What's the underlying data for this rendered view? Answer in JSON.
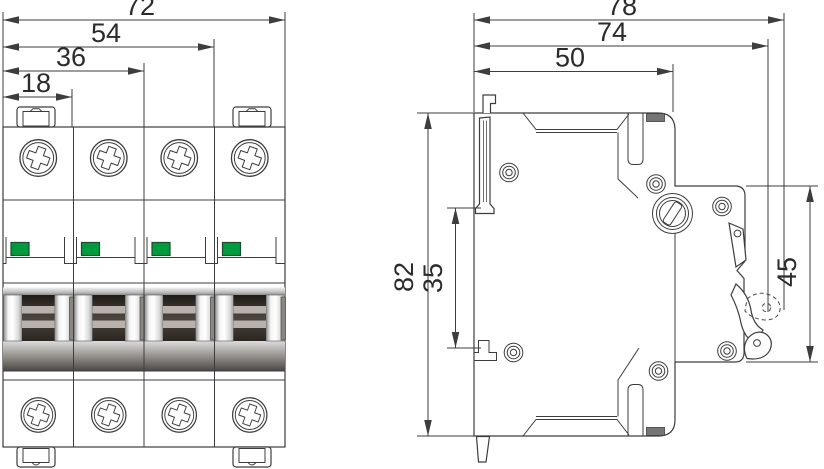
{
  "drawing": {
    "type": "technical-dimension-drawing",
    "front_view": {
      "dim_total_width": "72",
      "dim_three_modules": "54",
      "dim_two_modules": "36",
      "dim_one_module": "18",
      "pole_count": 4,
      "indicator_color": "#009b3e",
      "indicator_border": "#1d4a2c"
    },
    "side_view": {
      "dim_depth_total": "78",
      "dim_depth_to_handle": "74",
      "dim_depth_body": "50",
      "dim_height_total": "82",
      "dim_din_slot": "35",
      "dim_front_section": "45"
    },
    "style": {
      "line_color": "#3d3d3d",
      "background": "#ffffff"
    }
  }
}
